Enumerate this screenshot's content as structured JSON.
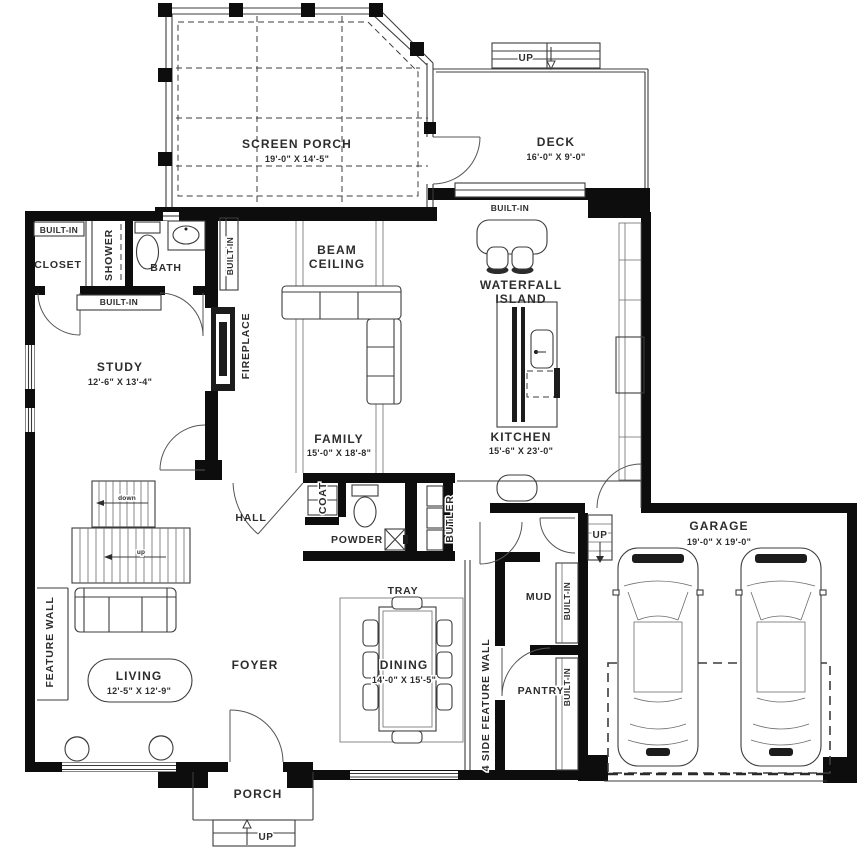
{
  "plan": {
    "rooms": {
      "screen_porch": {
        "name": "SCREEN PORCH",
        "dims": "19'-0\" X 14'-5\""
      },
      "deck": {
        "name": "DECK",
        "dims": "16'-0\" X 9'-0\""
      },
      "study": {
        "name": "STUDY",
        "dims": "12'-6\" X 13'-4\""
      },
      "family": {
        "name": "FAMILY",
        "dims": "15'-0\" X 18'-8\""
      },
      "kitchen": {
        "name": "KITCHEN",
        "dims": "15'-6\" X 23'-0\""
      },
      "living": {
        "name": "LIVING",
        "dims": "12'-5\" X 12'-9\""
      },
      "dining": {
        "name": "DINING",
        "dims": "14'-0\" X 15'-5\""
      },
      "garage": {
        "name": "GARAGE",
        "dims": "19'-0\" X 19'-0\""
      },
      "bath": {
        "name": "BATH"
      },
      "closet": {
        "name": "CLOSET"
      },
      "shower": {
        "name": "SHOWER"
      },
      "hall": {
        "name": "HALL"
      },
      "coat": {
        "name": "COAT"
      },
      "powder": {
        "name": "POWDER"
      },
      "butler": {
        "name": "BUTLER"
      },
      "mud": {
        "name": "MUD"
      },
      "pantry": {
        "name": "PANTRY"
      },
      "foyer": {
        "name": "FOYER"
      },
      "porch": {
        "name": "PORCH"
      },
      "tray": {
        "name": "TRAY"
      }
    },
    "features": {
      "built_in": "BUILT-IN",
      "beam_ceiling_line1": "BEAM",
      "beam_ceiling_line2": "CEILING",
      "waterfall_island_line1": "WATERFALL",
      "waterfall_island_line2": "ISLAND",
      "fireplace": "FIREPLACE",
      "feature_wall": "FEATURE WALL",
      "four_side_feature_wall": "4 SIDE FEATURE WALL"
    },
    "stairs": {
      "up": "UP",
      "up_lower": "up",
      "down_lower": "down"
    }
  },
  "colors": {
    "wall": "#0d0d0d",
    "line": "#3c3c3c",
    "text": "#2d2d2d",
    "background": "#ffffff"
  }
}
